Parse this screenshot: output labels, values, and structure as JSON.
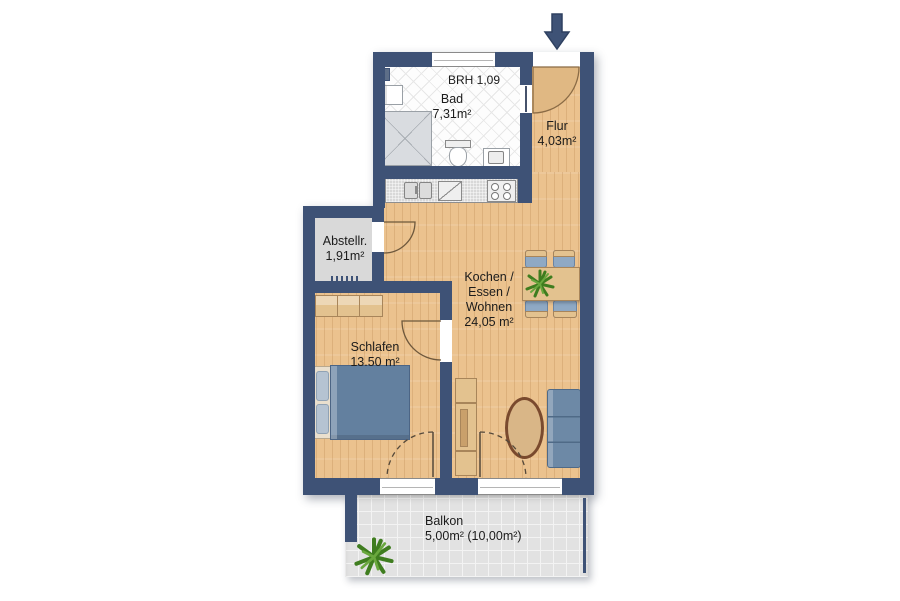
{
  "rooms": {
    "bad": {
      "name": "Bad",
      "area": "7,31m²"
    },
    "flur": {
      "name": "Flur",
      "area": "4,03m²"
    },
    "abstellraum": {
      "name": "Abstellr.",
      "area": "1,91m²"
    },
    "wohnen": {
      "name_line1": "Kochen /",
      "name_line2": "Essen /",
      "name_line3": "Wohnen",
      "area": "24,05 m²"
    },
    "schlafen": {
      "name": "Schlafen",
      "area": "13.50 m²"
    },
    "balkon": {
      "name": "Balkon",
      "area": "5,00m² (10,00m²)"
    }
  },
  "annotations": {
    "window_sill_height": "BRH 1,09"
  },
  "icons": {
    "entrance_arrow": "down-arrow",
    "plant_dining_table": "plant",
    "plant_balcony": "plant"
  },
  "colors": {
    "wall": "#3e5276",
    "wood_floor": "#ebc28e",
    "tile_floor": "#fdfdfd",
    "storage_floor": "#d9d9d9",
    "balcony_floor": "#e2e2e2",
    "upholstery_blue": "#6d89a6",
    "furniture_wood": "#e3c28f",
    "door_panel": "#e0b883",
    "plant_green": "#3f7d1f"
  }
}
